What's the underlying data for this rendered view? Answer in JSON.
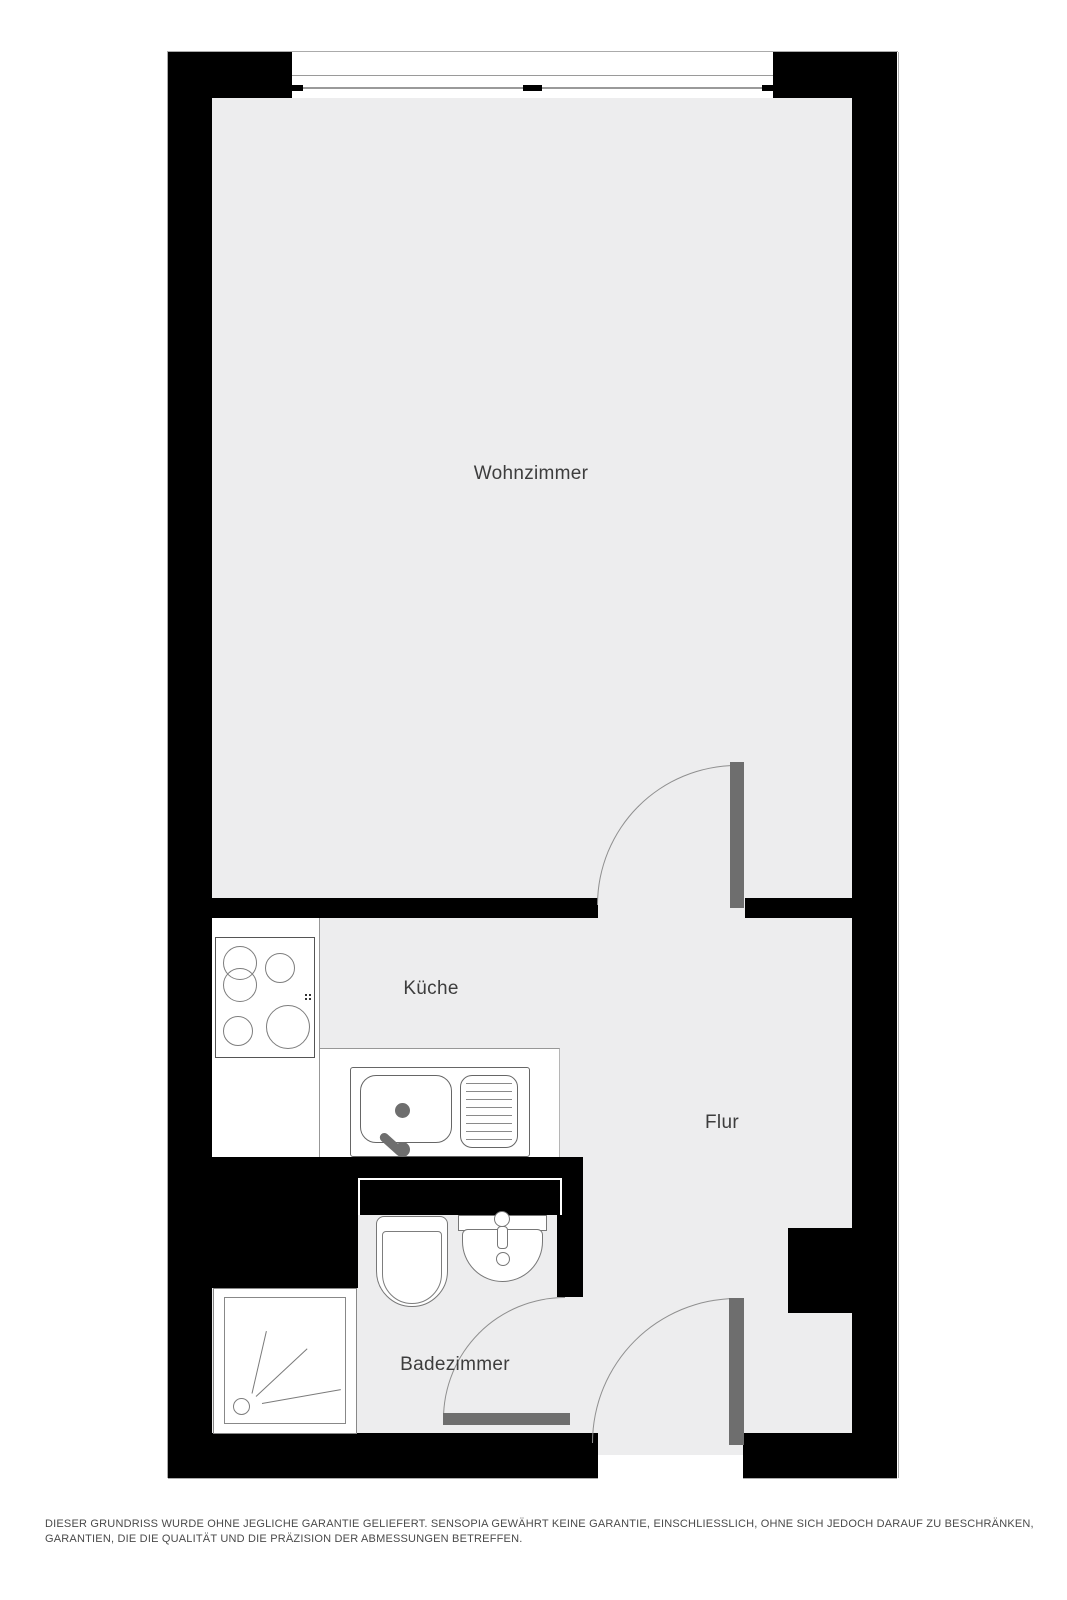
{
  "floorplan": {
    "rooms": [
      {
        "id": "wohnzimmer",
        "label": "Wohnzimmer"
      },
      {
        "id": "kueche",
        "label": "Küche"
      },
      {
        "id": "flur",
        "label": "Flur"
      },
      {
        "id": "badezimmer",
        "label": "Badezimmer"
      }
    ],
    "fixtures": [
      "stove-cooktop",
      "kitchen-sink",
      "toilet",
      "bathroom-sink",
      "shower"
    ],
    "door_count": 3,
    "window_count": 1,
    "colors": {
      "wall": "#000000",
      "floor": "#ededee",
      "door_leaf": "#6e6e6e",
      "fixture_outline": "#777777",
      "label_text": "#3d3d3d"
    }
  },
  "disclaimer": "DIESER GRUNDRISS WURDE OHNE JEGLICHE GARANTIE GELIEFERT. SENSOPIA GEWÄHRT KEINE GARANTIE, EINSCHLIESSLICH, OHNE SICH JEDOCH DARAUF ZU BESCHRÄNKEN, GARANTIEN, DIE DIE QUALITÄT UND DIE PRÄZISION DER ABMESSUNGEN BETREFFEN."
}
